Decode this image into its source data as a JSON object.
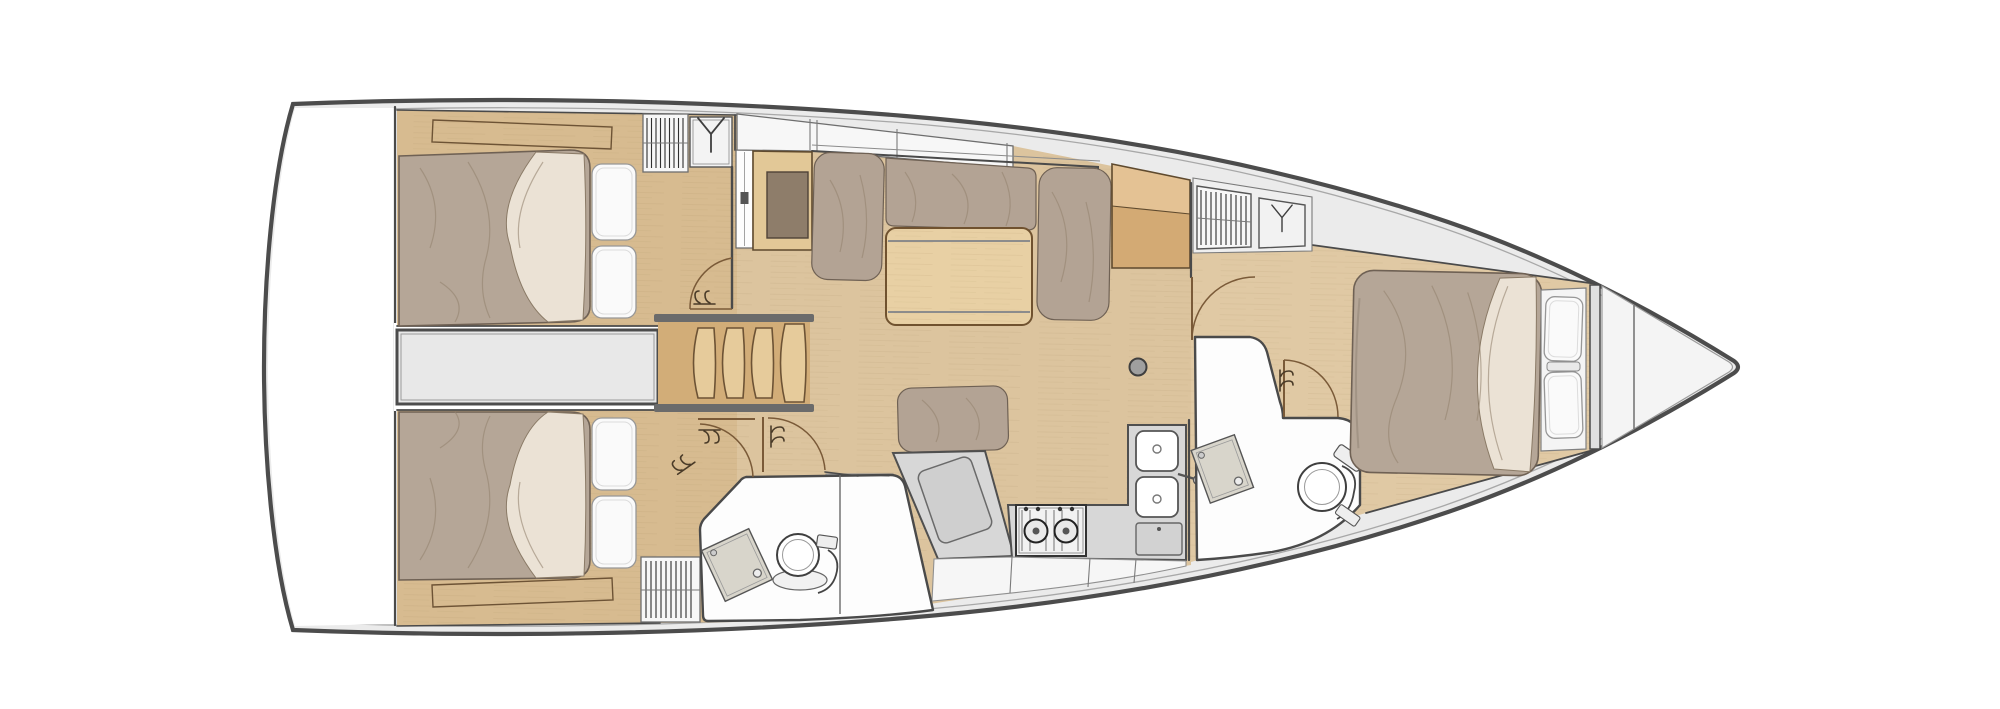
{
  "page": {
    "kind": "sailboat-interior-floorplan",
    "view": "top-down, bow pointing right, stern (swim platform) at left",
    "background": "#ffffff",
    "visible_text": []
  },
  "palette": {
    "hull_outline": "#4c4c4c",
    "hull_inner": "#a8a8a8",
    "deck": "#ebebeb",
    "wall": "#4a4a4a",
    "door_arc": "#7a5a38",
    "floor_salon": "#dcc49e",
    "floor_cabin": "#d7bb90",
    "floor_fwd": "#e0c9a4",
    "wood_furniture": "#e2c897",
    "amber_top": "#e4c294",
    "amber_bottom": "#d3aa74",
    "stairs_wood": "#e6cb9b",
    "stairs_side": "#d2ad78",
    "mattress": "#b5a697",
    "mattress_line": "#6f6154",
    "wrinkle": "#94846f",
    "sheet": "#ebe2d5",
    "pillow": "#fafafa",
    "pillow_line": "#979797",
    "cushion": "#b3a394",
    "white_room": "#fdfdfd",
    "gray_counter": "#d7d7d7",
    "counter_line": "#4f4f4f",
    "white_cab": "#f6f6f6",
    "locker_white": "#f7f7f7",
    "louver_line": "#2f2f2f",
    "engine": "#e8e8e8",
    "metal": "#8f8f8f"
  },
  "rooms": [
    {
      "id": "transom-platform",
      "name": "stern swim platform / lazarette"
    },
    {
      "id": "aft-cabin-starboard",
      "name": "aft double cabin (top)"
    },
    {
      "id": "aft-cabin-port",
      "name": "aft double cabin (bottom)"
    },
    {
      "id": "engine-compartment",
      "name": "engine compartment under companionway"
    },
    {
      "id": "companionway-stairs",
      "name": "companionway stairs, 4 treads"
    },
    {
      "id": "saloon",
      "name": "saloon with U-settee and folding table"
    },
    {
      "id": "nav-station",
      "name": "chart table / locker with brown top"
    },
    {
      "id": "galley",
      "name": "L-galley with 2-burner stove and double sink"
    },
    {
      "id": "aft-head",
      "name": "aft head with washbasin, toilet and shower"
    },
    {
      "id": "forward-cabin",
      "name": "forward cabin with island double berth"
    },
    {
      "id": "forward-head",
      "name": "forward en-suite head with basin and toilet"
    },
    {
      "id": "anchor-locker",
      "name": "bow / anchor locker"
    }
  ],
  "fixtures": [
    "double-bed-aft-starboard",
    "double-bed-aft-port",
    "island-bed-forward",
    "pillows",
    "saloon-table",
    "u-settee",
    "bench-settee",
    "two-burner-stove",
    "double-sink",
    "sink-faucet",
    "toilet-aft",
    "toilet-forward",
    "washbasin-aft",
    "washbasin-forward",
    "mast-post",
    "pocket-sliding-door",
    "hinged-door-swings"
  ],
  "icons": [
    "wardrobe-hanger-icon",
    "louvered-locker-icon",
    "coat-hooks-icon",
    "mast-symbol"
  ]
}
